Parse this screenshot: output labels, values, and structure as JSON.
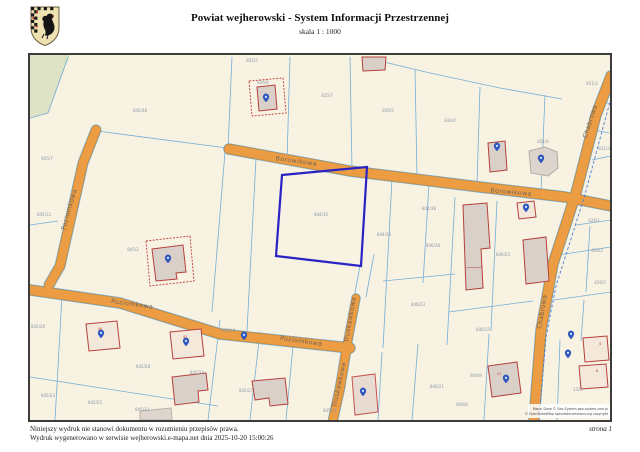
{
  "header": {
    "title": "Powiat wejherowski - System Informacji Przestrzennej",
    "scale": "skala 1 : 1000",
    "crest_alt": "herb powiatu wejherowskiego"
  },
  "footer": {
    "line1": "Niniejszy wydruk nie stanowi dokumentu w rozumieniu przepisów prawa.",
    "line2": "Wydruk wygenerowano w serwisie wejherowski.e-mapa.net dnia 2025-10-20 15:00:26",
    "page": "strona 1"
  },
  "map": {
    "selected_parcel": "844/35",
    "street_labels": [
      {
        "text": "Borowikowa",
        "x": 296,
        "y": 163,
        "rot": 8
      },
      {
        "text": "Borowikowa",
        "x": 511,
        "y": 194,
        "rot": 5
      },
      {
        "text": "Chabrowa",
        "x": 592,
        "y": 122,
        "rot": -72
      },
      {
        "text": "Chabrowa",
        "x": 544,
        "y": 312,
        "rot": -80
      },
      {
        "text": "Poziomkowa",
        "x": 71,
        "y": 210,
        "rot": -74
      },
      {
        "text": "Poziomkowa",
        "x": 132,
        "y": 306,
        "rot": 8
      },
      {
        "text": "Poziomkowa",
        "x": 301,
        "y": 343,
        "rot": 8
      },
      {
        "text": "Truskawkowa",
        "x": 352,
        "y": 320,
        "rot": -80
      },
      {
        "text": "Truskawkowa",
        "x": 341,
        "y": 385,
        "rot": -78
      }
    ],
    "parcel_labels": [
      {
        "text": "845/48",
        "x": 140,
        "y": 112
      },
      {
        "text": "845/7",
        "x": 47,
        "y": 160
      },
      {
        "text": "835/2",
        "x": 252,
        "y": 62
      },
      {
        "text": "836/6",
        "x": 263,
        "y": 84
      },
      {
        "text": "835/7",
        "x": 327,
        "y": 97
      },
      {
        "text": "836/5",
        "x": 388,
        "y": 112
      },
      {
        "text": "836/4",
        "x": 450,
        "y": 122
      },
      {
        "text": "831/4",
        "x": 543,
        "y": 143
      },
      {
        "text": "831/2",
        "x": 592,
        "y": 85
      },
      {
        "text": "831/3",
        "x": 604,
        "y": 150
      },
      {
        "text": "845/12",
        "x": 44,
        "y": 216
      },
      {
        "text": "845/2",
        "x": 133,
        "y": 251
      },
      {
        "text": "844/35",
        "x": 321,
        "y": 216
      },
      {
        "text": "844/33",
        "x": 384,
        "y": 236
      },
      {
        "text": "844/38",
        "x": 429,
        "y": 210
      },
      {
        "text": "846/28",
        "x": 433,
        "y": 247
      },
      {
        "text": "846/25",
        "x": 503,
        "y": 256
      },
      {
        "text": "426/1",
        "x": 594,
        "y": 222
      },
      {
        "text": "426/2",
        "x": 597,
        "y": 252
      },
      {
        "text": "426/3",
        "x": 600,
        "y": 284
      },
      {
        "text": "845/26",
        "x": 38,
        "y": 328
      },
      {
        "text": "845/19",
        "x": 228,
        "y": 332
      },
      {
        "text": "845/28",
        "x": 143,
        "y": 368
      },
      {
        "text": "845/24",
        "x": 197,
        "y": 374
      },
      {
        "text": "845/23",
        "x": 48,
        "y": 397
      },
      {
        "text": "845/25",
        "x": 95,
        "y": 404
      },
      {
        "text": "845/33",
        "x": 142,
        "y": 411
      },
      {
        "text": "845/27",
        "x": 246,
        "y": 392
      },
      {
        "text": "845/21",
        "x": 330,
        "y": 412
      },
      {
        "text": "846/23",
        "x": 418,
        "y": 306
      },
      {
        "text": "846/15",
        "x": 483,
        "y": 331
      },
      {
        "text": "846/21",
        "x": 437,
        "y": 388
      },
      {
        "text": "846/9",
        "x": 476,
        "y": 377
      },
      {
        "text": "846/8",
        "x": 462,
        "y": 406
      },
      {
        "text": "1323",
        "x": 578,
        "y": 391
      }
    ],
    "address_labels": [
      {
        "text": "40",
        "x": 100,
        "y": 330
      },
      {
        "text": "42",
        "x": 185,
        "y": 338
      },
      {
        "text": "4",
        "x": 600,
        "y": 345
      },
      {
        "text": "6",
        "x": 597,
        "y": 372
      },
      {
        "text": "12",
        "x": 499,
        "y": 375
      }
    ],
    "attribution": [
      {
        "text": "Mapa: Dane © Geo-System geo-system.com.pl",
        "x": 608,
        "y": 410
      },
      {
        "text": "© OpenStreetMap opendatacommons.org copyright",
        "x": 608,
        "y": 415
      }
    ],
    "colors": {
      "map_background": "#f8f2e3",
      "street": "#ec9d44",
      "street_casing": "#c8872e",
      "parcel_line": "#74aed6",
      "selection": "#2b22c4",
      "building_fill": "#d9d1c9",
      "building_outline": "#b5403c",
      "marker": "#2e59c7",
      "forest": "#dfe3c6"
    }
  }
}
